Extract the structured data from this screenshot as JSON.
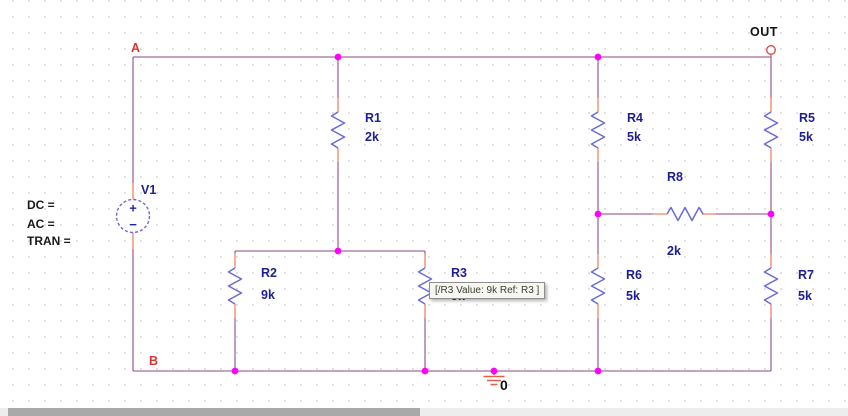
{
  "colors": {
    "wire": "#A06A9A",
    "pin": "#F08465",
    "component": "#6A6AD4",
    "junction_dot": "#FF00FF",
    "ref_text": "#1E1E96",
    "node_label": "#DD3333",
    "black_text": "#1A1A1A",
    "out_pin": "#D1493F",
    "ground": "#E4604E"
  },
  "node_labels": {
    "a": "A",
    "b": "B",
    "out": "OUT",
    "ground": "0"
  },
  "source": {
    "ref": "V1",
    "plus": "+",
    "minus": "−",
    "params": {
      "dc": "DC =",
      "ac": "AC =",
      "tran": "TRAN ="
    }
  },
  "resistors": {
    "r1": {
      "ref": "R1",
      "value": "2k"
    },
    "r2": {
      "ref": "R2",
      "value": "9k"
    },
    "r3": {
      "ref": "R3",
      "value": "9k"
    },
    "r4": {
      "ref": "R4",
      "value": "5k"
    },
    "r5": {
      "ref": "R5",
      "value": "5k"
    },
    "r6": {
      "ref": "R6",
      "value": "5k"
    },
    "r7": {
      "ref": "R7",
      "value": "5k"
    },
    "r8": {
      "ref": "R8",
      "value": "2k"
    }
  },
  "tooltip": {
    "text": "[/R3 Value: 9k Ref: R3 ]"
  }
}
